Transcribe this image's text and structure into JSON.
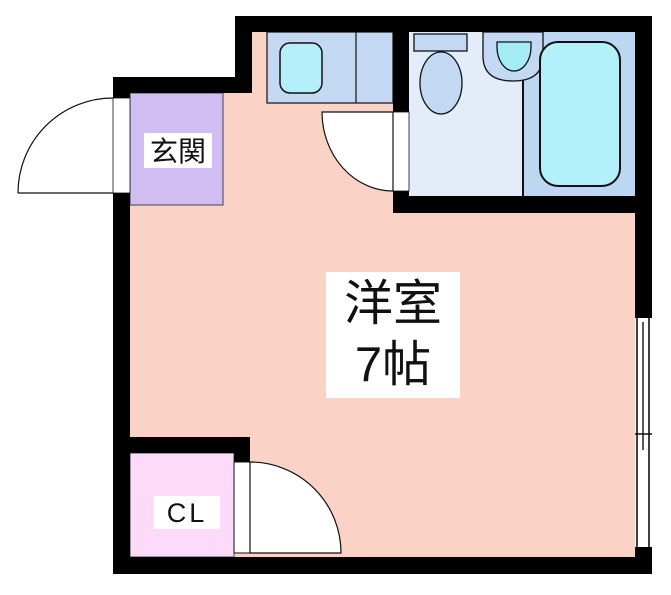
{
  "plan": {
    "main_room": {
      "name_line1": "洋室",
      "name_line2": "7帖"
    },
    "entrance": {
      "label": "玄関"
    },
    "closet": {
      "label": "CL"
    }
  },
  "fixtures": {
    "bathtub": "bathtub-icon",
    "toilet": "toilet-icon",
    "wash_basin": "wash-basin-icon",
    "kitchen_sink": "kitchen-sink-icon",
    "window": "sliding-window",
    "door_swing": "door-swing-arc"
  },
  "colors": {
    "wall": "#000000",
    "outline": "#111111",
    "main_room": "#fad2c6",
    "entrance": "#d2bdf2",
    "closet": "#fedafa",
    "washroom_floor": "#e2edf9",
    "bath_floor": "#bdd6f1",
    "fixture_blue": "#c3d9f3",
    "tub_cyan": "#b2f0fa",
    "kitchen_sink_cyan": "#b4eef8",
    "basin_cyan": "#a4ebf5",
    "counter_blue": "#c3d9f3",
    "door_white": "#ffffff",
    "label_bg": "#ffffff",
    "text": "#111111"
  }
}
